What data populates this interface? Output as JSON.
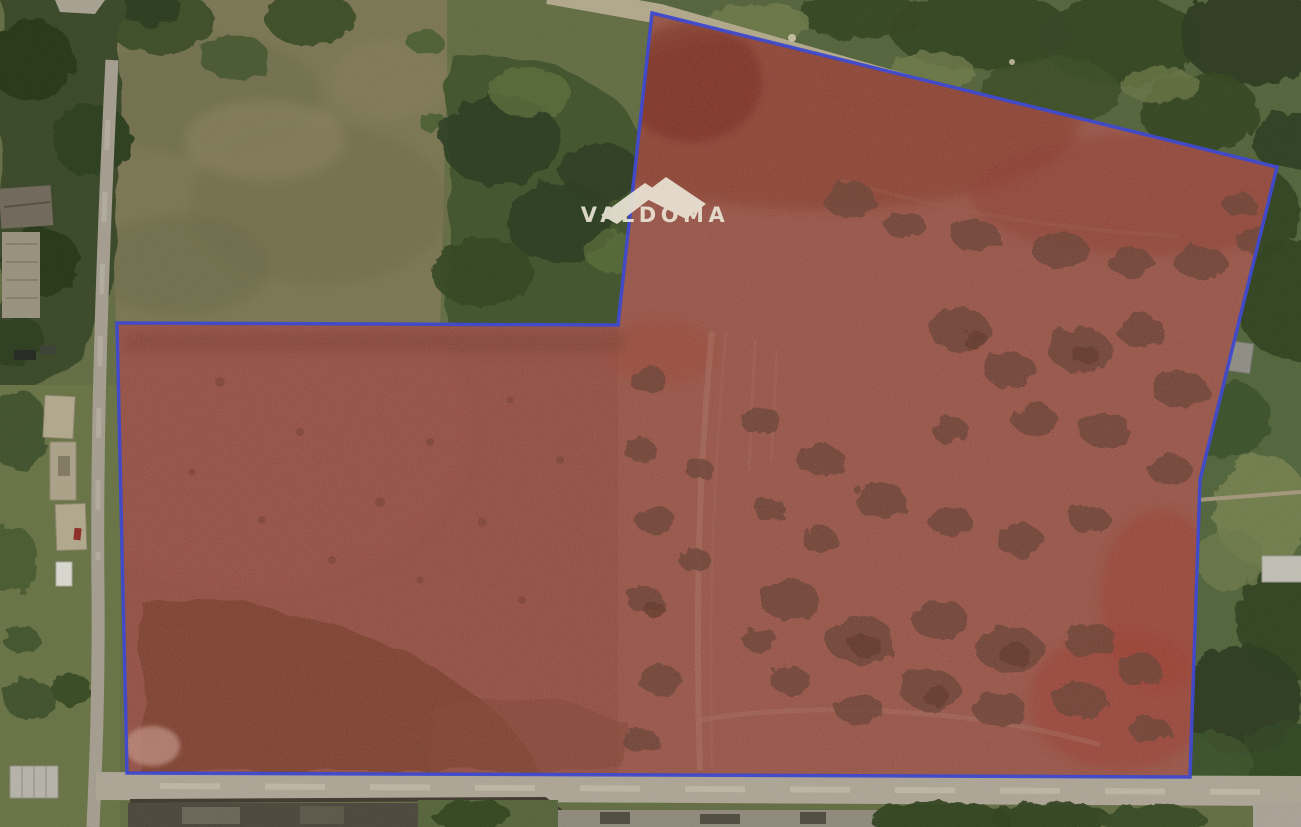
{
  "image": {
    "type": "satellite-photo",
    "description": "Aerial view of an irregular land parcel outlined in blue and highlighted in translucent red, bordered by roads, fields and trees"
  },
  "watermark": {
    "label": "VALDOMA",
    "color": "#ece6d6"
  },
  "parcel": {
    "boundary_color": "#3a45cd",
    "boundary_width": "3.5",
    "fill_color": "#a03225",
    "fill_opacity": "0.18",
    "vertices": "652,13 1277,167 1200,480 1190,777 127,773 117,323 618,325"
  }
}
